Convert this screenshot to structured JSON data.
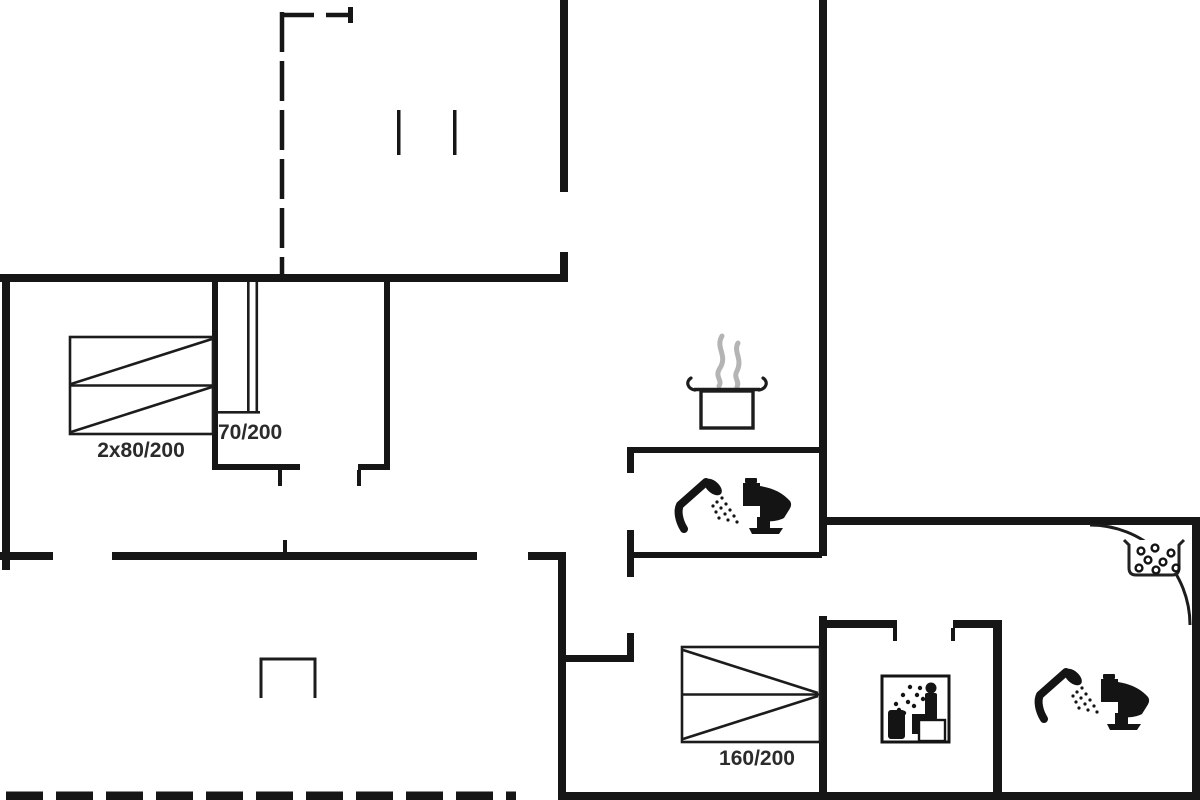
{
  "floor_plan": {
    "background_color": "#ffffff",
    "wall_color": "#161616",
    "thin_line_color": "#1c1c1c",
    "steam_color": "#b4b4b4",
    "label_color": "#2b2b2b",
    "labels": {
      "double_bed_size": "2x80/200",
      "door_size": "70/200",
      "bed_size": "160/200"
    },
    "icons": [
      "cooking-pot-with-steam",
      "hand-shower",
      "toilet",
      "sauna-person",
      "pebble-tub",
      "door-swing-arc",
      "double-bed",
      "single-wide-bed"
    ]
  }
}
